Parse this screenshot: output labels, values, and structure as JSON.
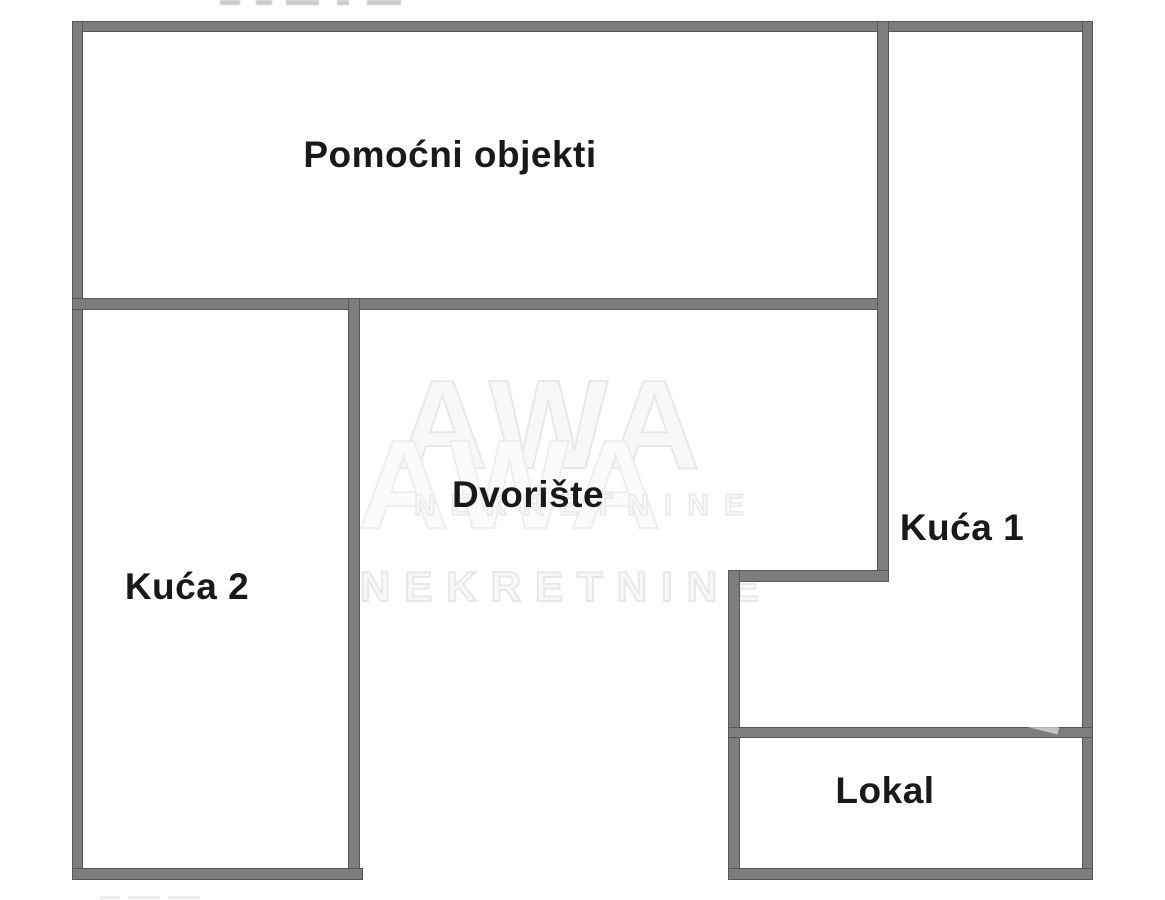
{
  "floor_plan": {
    "rooms": {
      "pomocni_objekti": {
        "label": "Pomoćni objekti"
      },
      "kuca_2": {
        "label": "Kuća 2"
      },
      "dvoriste": {
        "label": "Dvorište"
      },
      "kuca_1": {
        "label": "Kuća 1"
      },
      "lokal": {
        "label": "Lokal"
      }
    },
    "watermark": {
      "logo": "AWA",
      "name": "NEKRETNINE"
    },
    "colors": {
      "wall": "#7d7d7d",
      "wall_edge": "#575757",
      "background": "#ffffff",
      "label_text": "#191919",
      "watermark": "#e8e8e8"
    }
  }
}
